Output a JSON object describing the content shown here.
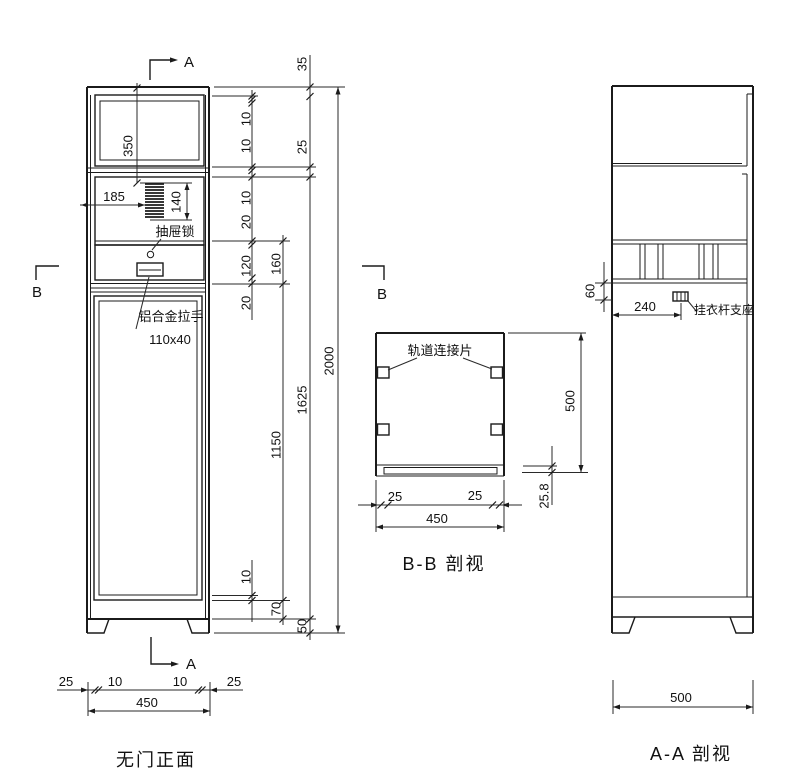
{
  "drawing": {
    "front_view": {
      "caption": "无门正面",
      "marker_a_top": "A",
      "marker_a_bottom": "A",
      "marker_b_left": "B",
      "marker_b_right": "B",
      "labels": {
        "drawer_lock": "抽屉锁",
        "handle": "铝合金拉手",
        "handle_size": "110x40"
      },
      "dims": {
        "top_compartment": "350",
        "vent_offset": "185",
        "vent_height": "140",
        "width": "450"
      },
      "chain1": [
        "10",
        "10",
        "10",
        "20",
        "120",
        "20",
        "10"
      ],
      "chain2": [
        "160",
        "1150",
        "70"
      ],
      "chain3": [
        "35",
        "25",
        "1625",
        "50"
      ],
      "chain4": [
        "2000"
      ],
      "bottom_chain": [
        "25",
        "10",
        "10",
        "25"
      ]
    },
    "bb_section": {
      "caption": "B-B 剖视",
      "labels": {
        "rail_connector": "轨道连接片"
      },
      "dims": {
        "inset_left": "25",
        "inset_right": "25",
        "width": "450",
        "height": "500",
        "base_height": "25.8"
      }
    },
    "aa_section": {
      "caption": "A-A 剖视",
      "labels": {
        "hanger_support": "挂衣杆支座"
      },
      "dims": {
        "rail_gap": "60",
        "support_offset": "240",
        "depth": "500"
      }
    }
  }
}
